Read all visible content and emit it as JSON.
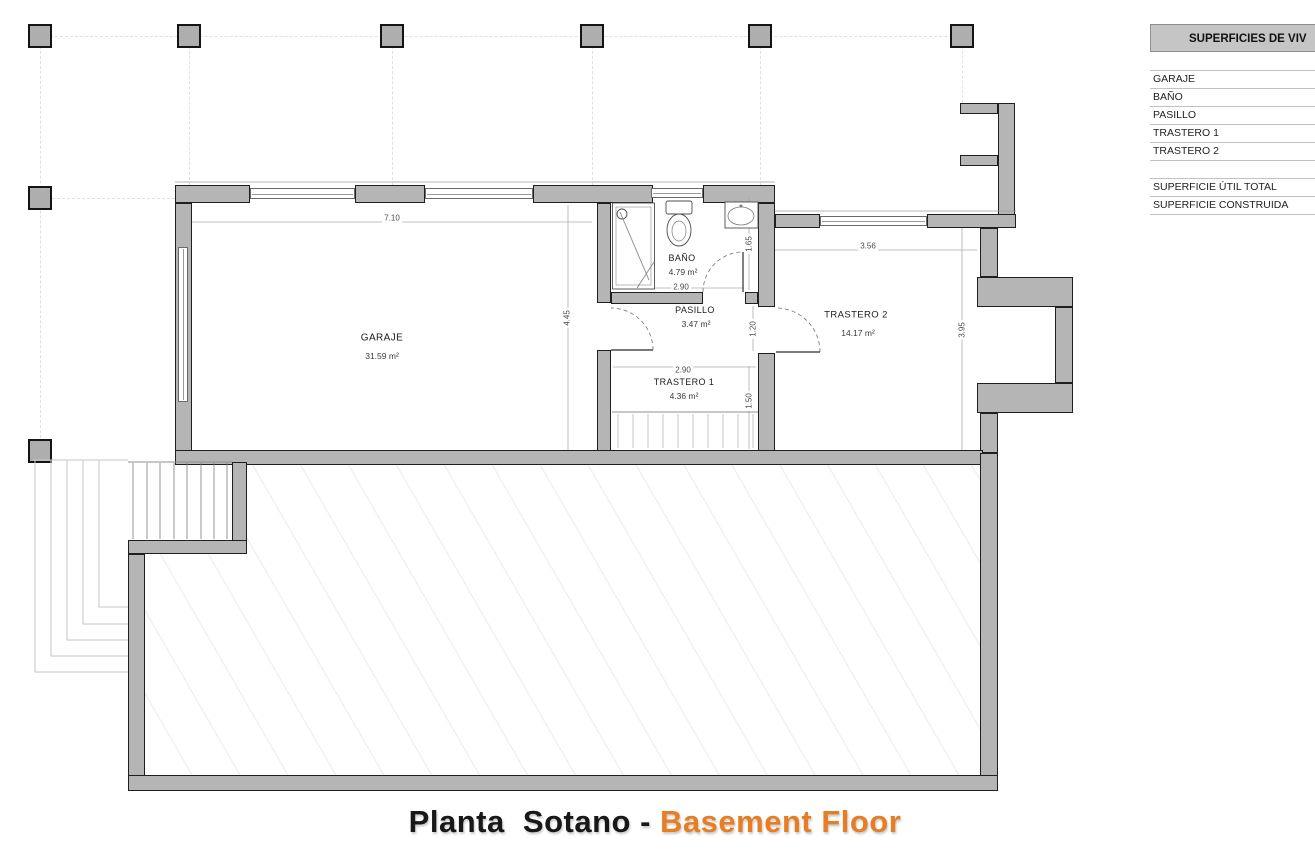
{
  "title": {
    "part1": "Planta  Sotano - ",
    "part2": "Basement Floor",
    "accent_color": "#e87e23"
  },
  "table": {
    "header": "SUPERFICIES DE VIV",
    "rows": [
      "GARAJE",
      "BAÑO",
      "PASILLO",
      "TRASTERO 1",
      "TRASTERO 2",
      "",
      "SUPERFICIE ÚTIL TOTAL",
      "SUPERFICIE CONSTRUIDA"
    ]
  },
  "plan": {
    "garaje": {
      "name": "GARAJE",
      "area": "31.59 m²"
    },
    "bano": {
      "name": "BAÑO",
      "area": "4.79 m²",
      "width": "2.90",
      "height": "1.65"
    },
    "pasillo": {
      "name": "PASILLO",
      "area": "3.47 m²",
      "width": "1.20"
    },
    "trastero1": {
      "name": "TRASTERO 1",
      "area": "4.36 m²",
      "width": "2.90",
      "height": "1.50"
    },
    "trastero2": {
      "name": "TRASTERO 2",
      "area": "14.17 m²",
      "width": "3.56",
      "depth": "3.95"
    },
    "garage_width": "7.10",
    "garage_depth": "4.45"
  },
  "colors": {
    "wall_fill": "#b5b5b5",
    "wall_stroke": "#1f1f1f",
    "table_header_bg": "#c5c5c5",
    "title_accent": "#e87e23"
  }
}
